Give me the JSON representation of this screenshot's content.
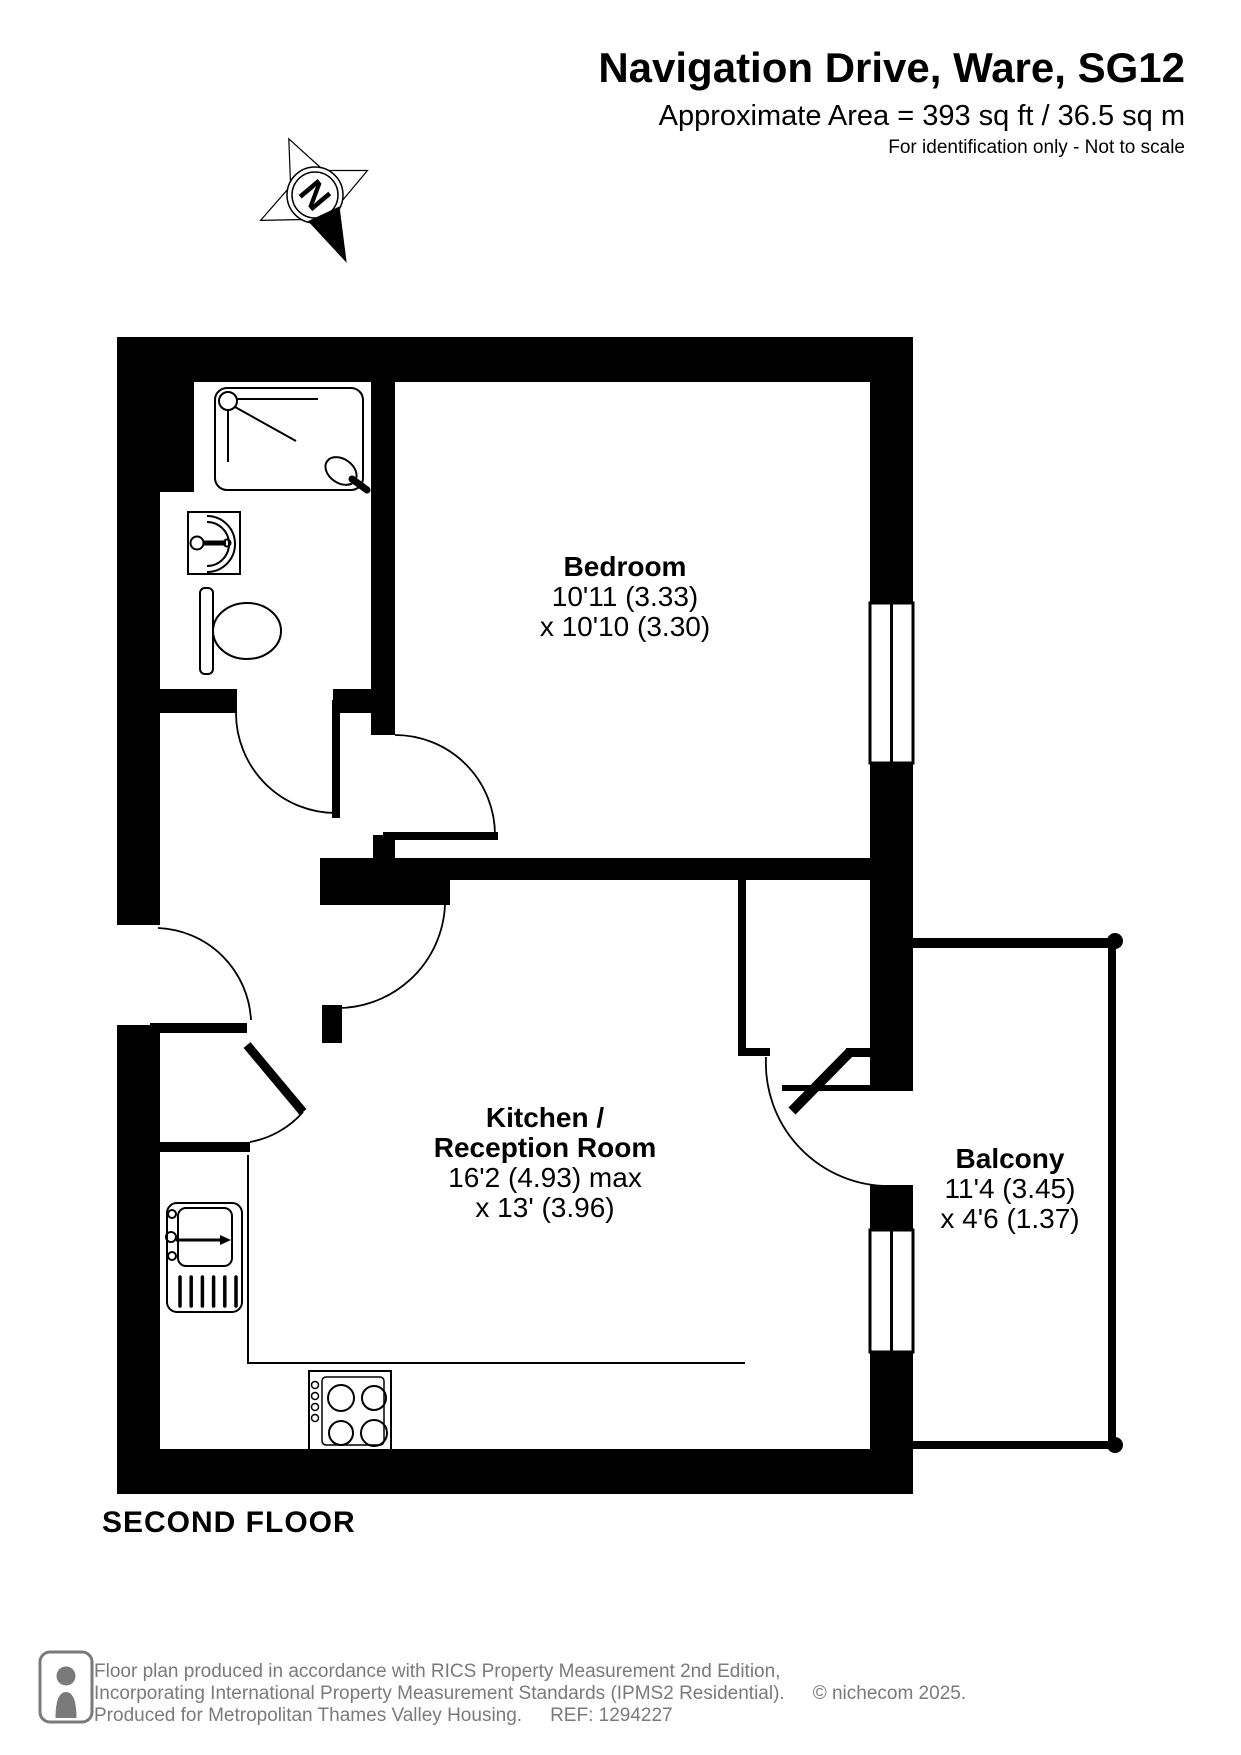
{
  "header": {
    "title": "Navigation Drive, Ware, SG12",
    "area": "Approximate Area = 393 sq ft / 36.5 sq m",
    "disclaimer": "For identification only - Not to scale"
  },
  "compass": {
    "letter": "N"
  },
  "rooms": {
    "bedroom": {
      "name": "Bedroom",
      "dim1": "10'11 (3.33)",
      "dim2": "x 10'10 (3.30)"
    },
    "kitchen": {
      "name1": "Kitchen /",
      "name2": "Reception Room",
      "dim1": "16'2 (4.93) max",
      "dim2": "x 13' (3.96)"
    },
    "balcony": {
      "name": "Balcony",
      "dim1": "11'4 (3.45)",
      "dim2": "x 4'6 (1.37)"
    }
  },
  "floor_label": "SECOND FLOOR",
  "footer": {
    "line1": "Floor plan produced in accordance with RICS Property Measurement 2nd Edition,",
    "line2": "Incorporating International Property Measurement Standards (IPMS2 Residential).",
    "copyright": "© nichecom 2025.",
    "line3": "Produced for Metropolitan Thames Valley Housing.",
    "ref": "REF:  1294227"
  },
  "colors": {
    "ink": "#000000",
    "muted": "#7a7a7a"
  }
}
